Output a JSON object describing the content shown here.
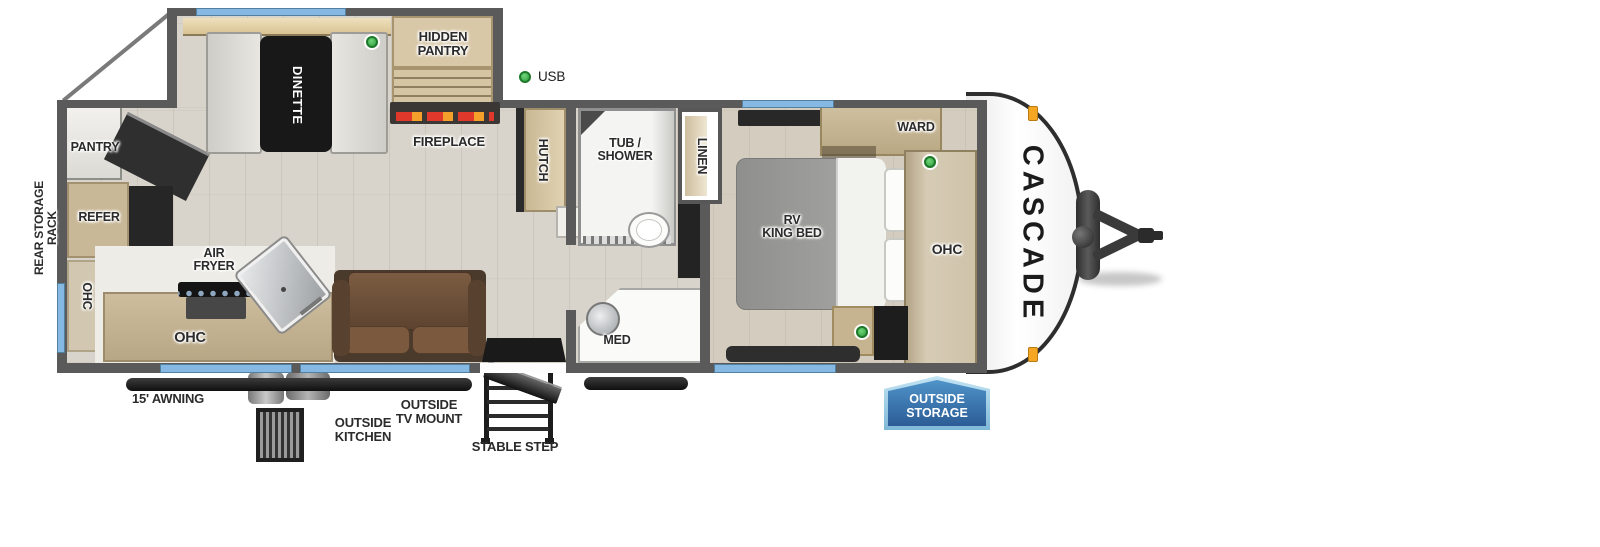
{
  "model_logo": "CASCADE",
  "legend": {
    "usb": "USB"
  },
  "exterior": {
    "rear_storage_rack": "REAR STORAGE RACK",
    "awning": "15' AWNING",
    "outside_kitchen": "OUTSIDE\nKITCHEN",
    "outside_tv_mount": "OUTSIDE\nTV MOUNT",
    "stable_step": "STABLE STEP",
    "outside_storage": "OUTSIDE\nSTORAGE"
  },
  "rooms": {
    "dinette": "DINETTE",
    "hidden_pantry": "HIDDEN\nPANTRY",
    "fireplace": "FIREPLACE",
    "hutch": "HUTCH",
    "pantry": "PANTRY",
    "refer": "REFER",
    "ohc_rear": "OHC",
    "ohc_kitchen": "OHC",
    "air_fryer": "AIR\nFRYER",
    "sofa": "SOFA",
    "tub_shower": "TUB /\nSHOWER",
    "linen": "LINEN",
    "med": "MED",
    "rv_king_bed": "RV\nKING BED",
    "ward": "WARD",
    "ohc_bedroom": "OHC"
  },
  "colors": {
    "window_blue": "#85b9e4",
    "usb_green": "#2f9c3c",
    "storage_badge_blue": "#2c5c96",
    "wall_gray": "#5a5a5a",
    "sofa_brown": "#6a4e37"
  }
}
